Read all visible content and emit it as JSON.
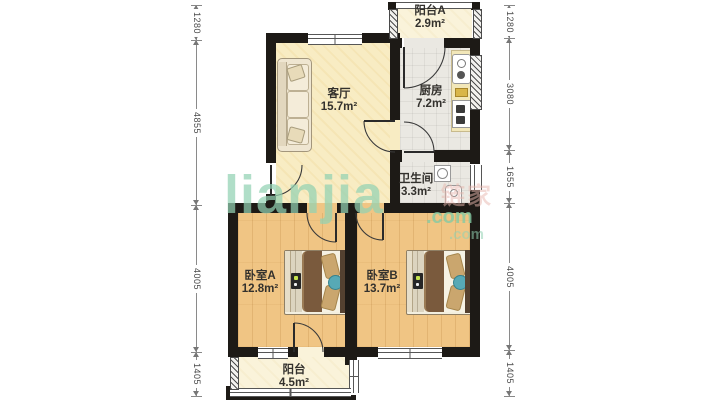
{
  "watermark": {
    "brand": "lianjia",
    "suffix": ".com",
    "brand_cn": "链家",
    "cn_suffix": ".com"
  },
  "rooms": [
    {
      "id": "balcony-a",
      "name": "阳台A",
      "area": "2.9m²"
    },
    {
      "id": "kitchen",
      "name": "厨房",
      "area": "7.2m²"
    },
    {
      "id": "living-room",
      "name": "客厅",
      "area": "15.7m²"
    },
    {
      "id": "bathroom",
      "name": "卫生间",
      "area": "3.3m²"
    },
    {
      "id": "bedroom-a",
      "name": "卧室A",
      "area": "12.8m²"
    },
    {
      "id": "bedroom-b",
      "name": "卧室B",
      "area": "13.7m²"
    },
    {
      "id": "balcony",
      "name": "阳台",
      "area": "4.5m²"
    }
  ],
  "dimensions": {
    "left": [
      {
        "label": "1280"
      },
      {
        "label": "4855"
      },
      {
        "label": "4005"
      },
      {
        "label": "1405"
      }
    ],
    "right": [
      {
        "label": "1280"
      },
      {
        "label": "3080"
      },
      {
        "label": "1655"
      },
      {
        "label": "4005"
      },
      {
        "label": "1405"
      }
    ]
  },
  "colors": {
    "wall": "#1d1a16",
    "living_floor": "#f8ecc3",
    "wood_floor": "#f0c584",
    "tile_floor": "#eae8e2",
    "balcony_floor": "#faf3da",
    "watermark_green": "#93d2b3",
    "watermark_pink": "#e8b7ae"
  }
}
